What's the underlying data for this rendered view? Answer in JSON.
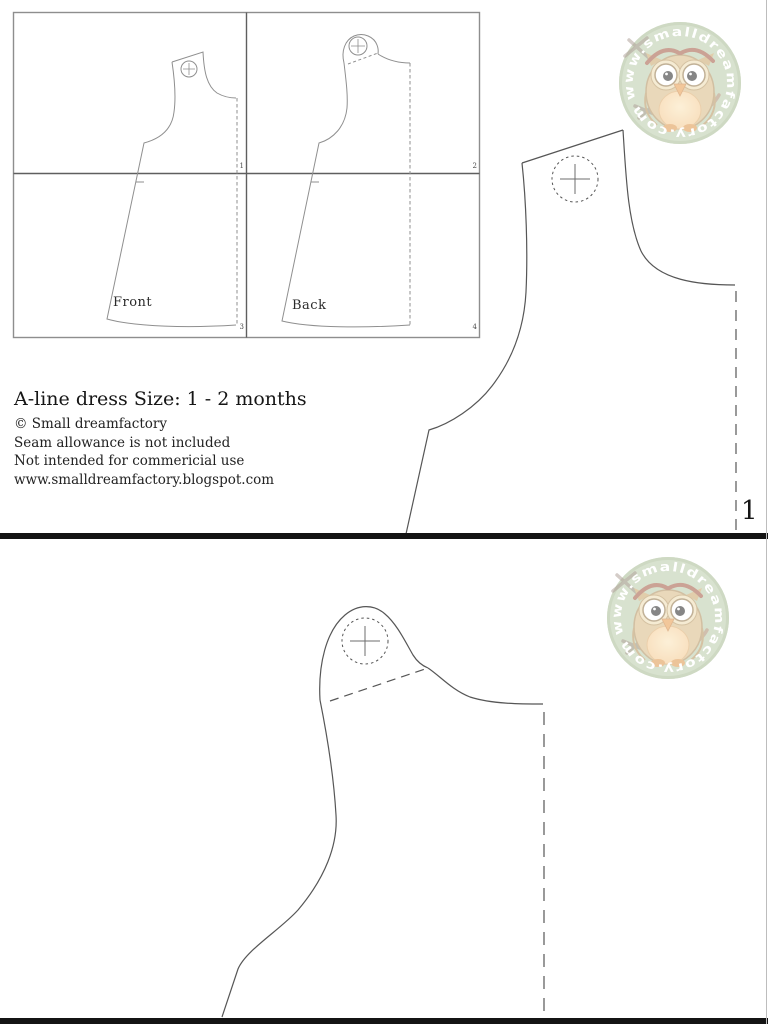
{
  "document_type": "sewing-pattern-sheet",
  "colors": {
    "badge_green": "#b6c9a4",
    "badge_ring": "#a2b78d",
    "owl_body": "#d6b67d",
    "owl_belly": "#f4c98d",
    "owl_accent": "#9c4f35",
    "pattern_line": "#565656",
    "diagram_line": "#8e8e8e",
    "divider_black": "#141414"
  },
  "logo": {
    "url_text": "www.smalldreamfactory.com"
  },
  "page1": {
    "diagram": {
      "front_label": "Front",
      "back_label": "Back",
      "tiles": [
        "1",
        "2",
        "3",
        "4"
      ]
    },
    "info": {
      "title": "A-line dress Size: 1 - 2 months",
      "copyright": "© Small dreamfactory",
      "seam_note": "Seam allowance is not included",
      "usage_note": "Not intended for commericial use",
      "website": "www.smalldreamfactory.blogspot.com"
    },
    "sheet_number": "1"
  }
}
